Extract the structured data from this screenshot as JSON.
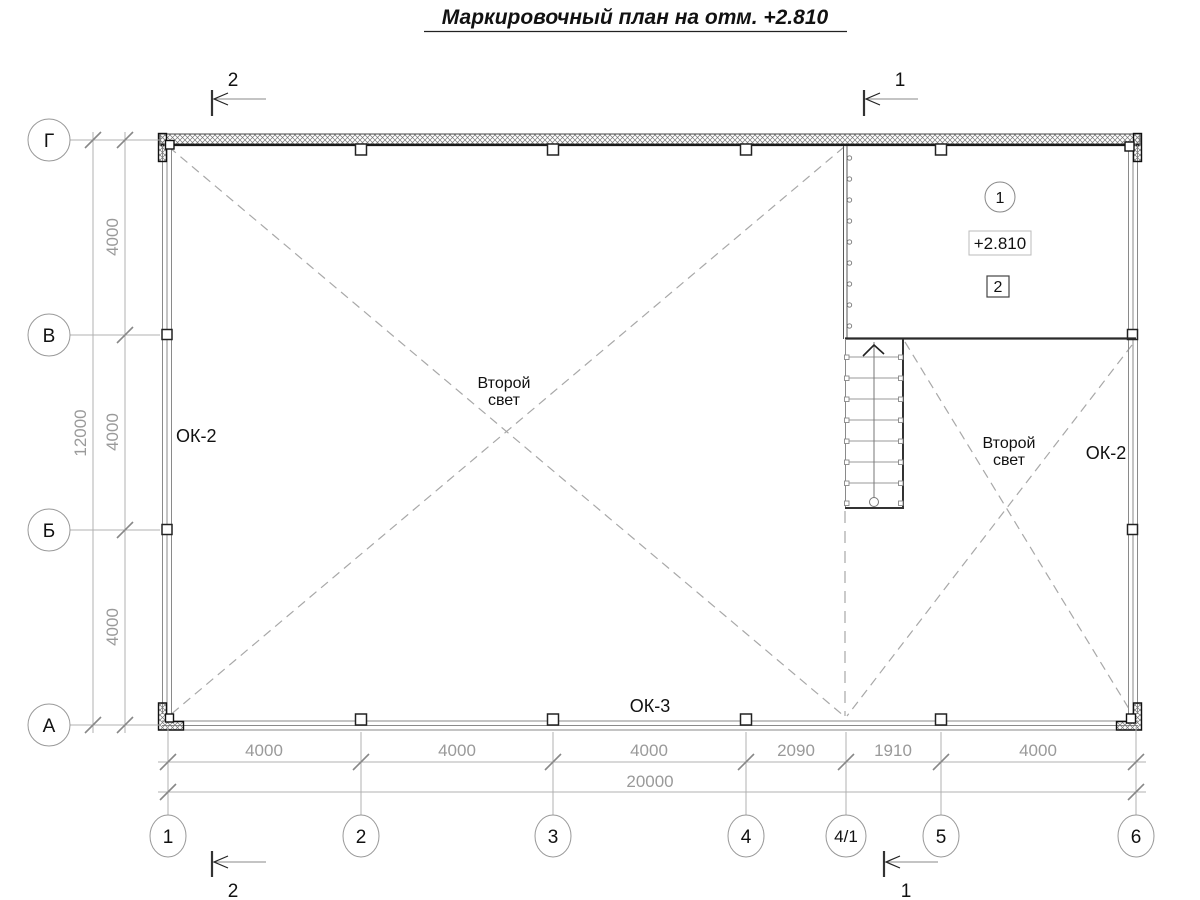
{
  "title": "Маркировочный план на отм. +2.810",
  "axes": {
    "bottom": [
      "1",
      "2",
      "3",
      "4",
      "4/1",
      "5",
      "6"
    ],
    "left": [
      "Г",
      "В",
      "Б",
      "А"
    ]
  },
  "dimensions": {
    "bottom_segments": [
      "4000",
      "4000",
      "4000",
      "2090",
      "1910",
      "4000"
    ],
    "bottom_total": "20000",
    "left_segments": [
      "4000",
      "4000",
      "4000"
    ],
    "left_total": "12000"
  },
  "sections": {
    "top_left": "2",
    "top_right": "1",
    "bottom_left": "2",
    "bottom_right": "1"
  },
  "labels": {
    "window_left": "ОК-2",
    "window_right": "ОК-2",
    "window_bottom": "ОК-3",
    "void_line1": "Второй",
    "void_line2": "свет",
    "room_number": "1",
    "elevation": "+2.810",
    "detail_mark": "2"
  },
  "colors": {
    "wall": "#1a1a1a",
    "window_line": "#8a8a8a",
    "dim_line": "#b0b0b0",
    "dash_line": "#a8a8a8",
    "dim_text": "#9a9a9a"
  }
}
